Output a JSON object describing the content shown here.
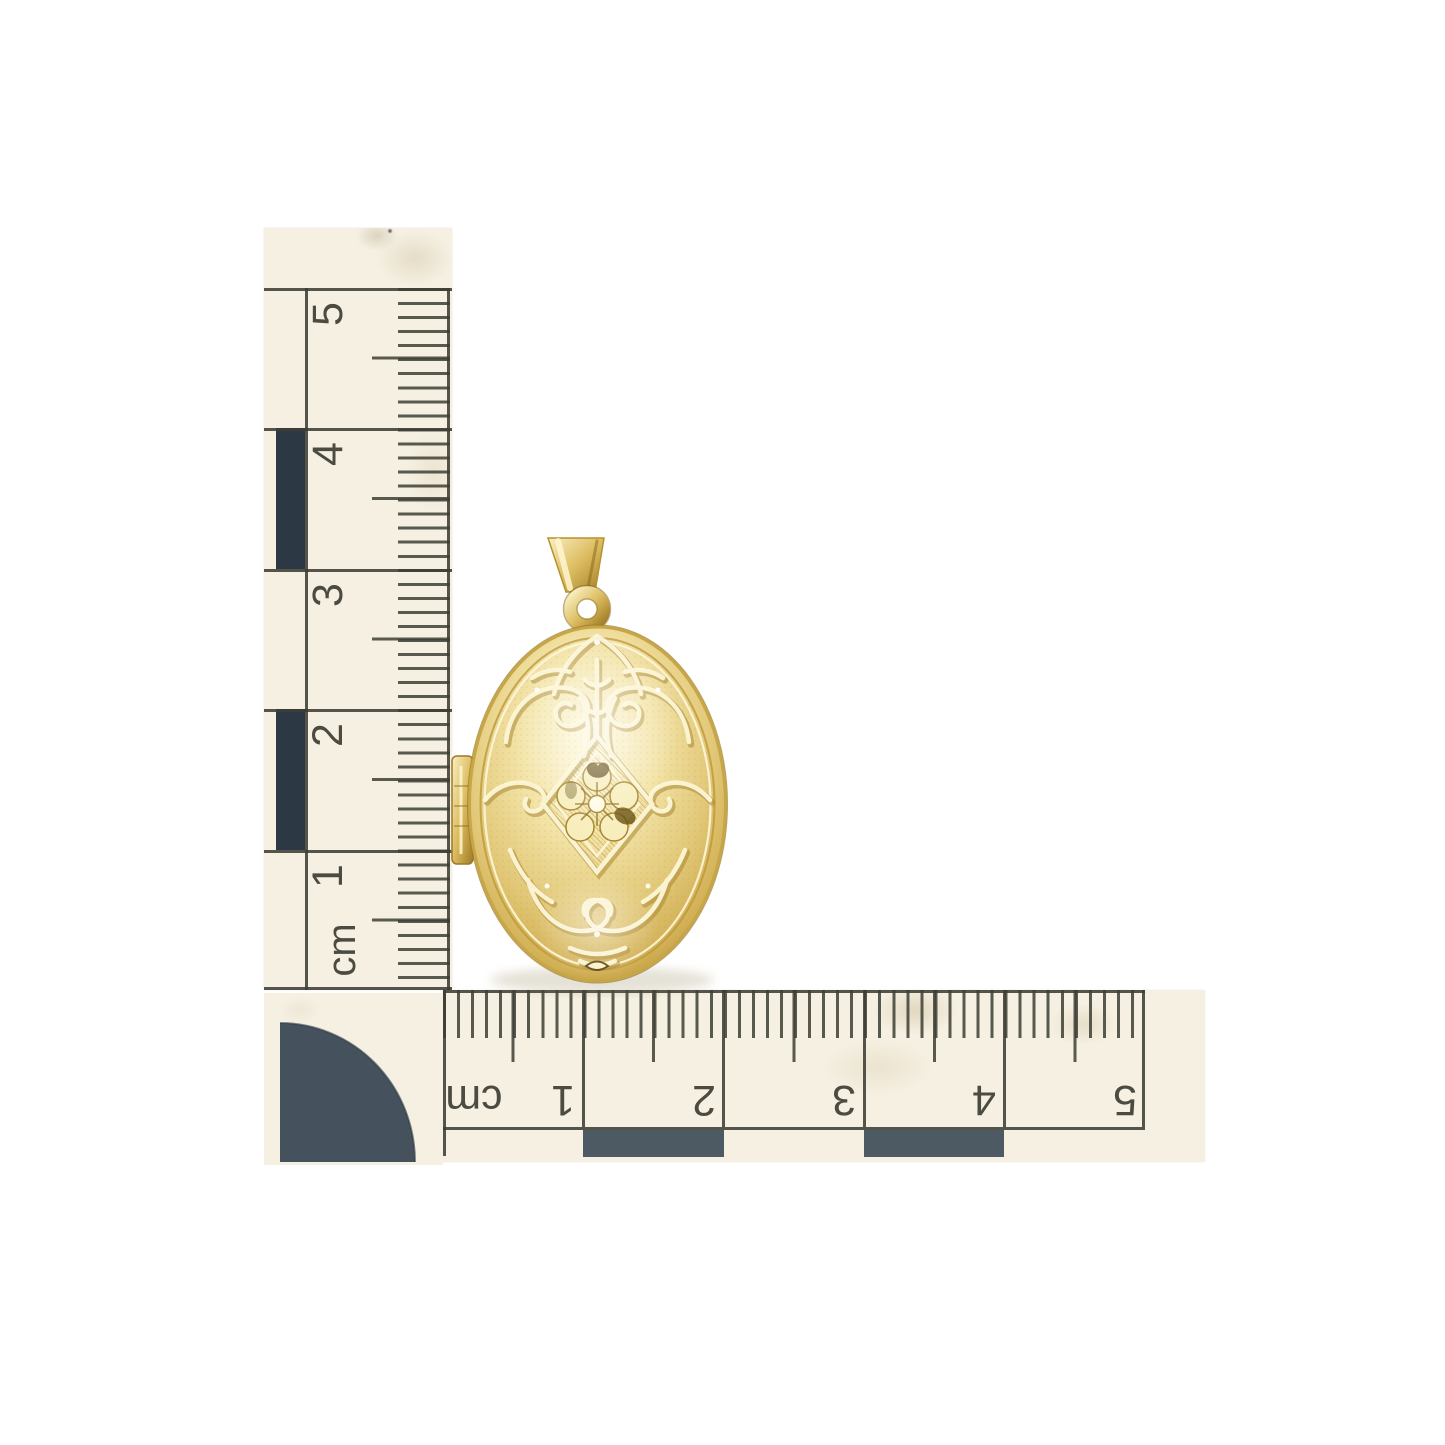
{
  "scene": {
    "description": "Gold engraved oval locket pendant photographed on white with two printed centimetre paper rulers (one vertical, one horizontal upside-down) and a quarter-circle corner scale marker",
    "background_color": "#ffffff"
  },
  "vertical_ruler": {
    "unit_label": "cm",
    "tick_labels": [
      "5",
      "4",
      "3",
      "2",
      "1"
    ]
  },
  "horizontal_ruler": {
    "unit_label": "cm",
    "tick_labels": [
      "1",
      "2",
      "3",
      "4",
      "5"
    ]
  },
  "colors": {
    "paper": "#f5f0e2",
    "ink": "#3e3e34",
    "block-dark": "#2c3844",
    "block-mid": "#4e5a63",
    "disc": "#45525e",
    "gold-light": "#fbf3cd",
    "gold-mid": "#e2c878",
    "gold-deep": "#b98f33"
  }
}
